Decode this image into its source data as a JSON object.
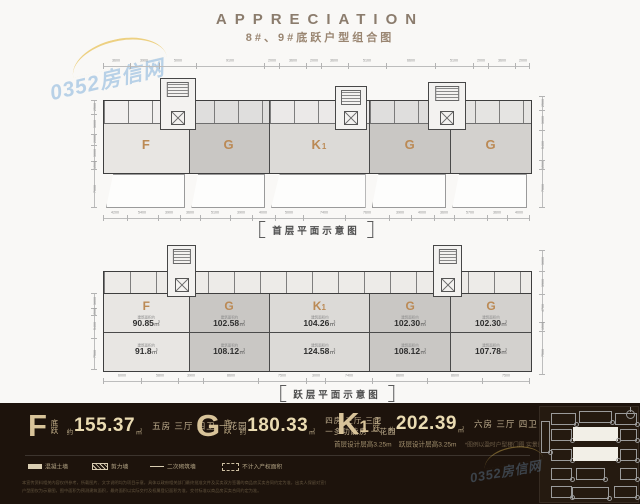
{
  "header": {
    "title": "APPRECIATION",
    "subtitle": "8#、9#底跃户型组合图"
  },
  "watermark": {
    "text": "0352房信网"
  },
  "plan1": {
    "caption": "首层平面示意图",
    "units": [
      {
        "label": "F",
        "sub": ""
      },
      {
        "label": "G",
        "sub": ""
      },
      {
        "label": "K",
        "sub": "1"
      },
      {
        "label": "G",
        "sub": ""
      },
      {
        "label": "G",
        "sub": ""
      }
    ],
    "dims_top": [
      "3600",
      "3900",
      "5000",
      "9100",
      "2000",
      "3600",
      "2000",
      "3600",
      "5100",
      "6600",
      "5100",
      "2000",
      "3600",
      "2000"
    ],
    "dims_bottom": [
      "4200",
      "5400",
      "3900",
      "3600",
      "5100",
      "3900",
      "4000",
      "5000",
      "7400",
      "7600",
      "3900",
      "4000",
      "3600",
      "5700",
      "3600",
      "4000"
    ],
    "dims_left": [
      "2500",
      "3600",
      "2000",
      "3000",
      "1500",
      "7000"
    ],
    "dims_right": [
      "2500",
      "3600",
      "5400",
      "1500",
      "7000"
    ]
  },
  "plan2": {
    "caption": "跃层平面示意图",
    "area_note": "建筑面积约",
    "units": [
      {
        "label": "F",
        "sub": "",
        "upper": "90.85",
        "lower": "91.8",
        "unit": "㎡"
      },
      {
        "label": "G",
        "sub": "",
        "upper": "102.58",
        "lower": "108.12",
        "unit": "㎡"
      },
      {
        "label": "K",
        "sub": "1",
        "upper": "104.26",
        "lower": "124.58",
        "unit": "㎡"
      },
      {
        "label": "G",
        "sub": "",
        "upper": "102.30",
        "lower": "108.12",
        "unit": "㎡"
      },
      {
        "label": "G",
        "sub": "",
        "upper": "102.30",
        "lower": "107.78",
        "unit": "㎡"
      }
    ],
    "dims_left": [
      "3600",
      "1500",
      "5400",
      "7500"
    ],
    "dims_right": [
      "3600",
      "3900",
      "4700",
      "1500",
      "7500"
    ],
    "dims_bottom": [
      "6000",
      "5800",
      "3900",
      "8600",
      "7500",
      "3000",
      "7400",
      "8600",
      "8600",
      "7500"
    ]
  },
  "footer": {
    "units": [
      {
        "letter": "F",
        "letter_sub": "",
        "tier": "底跃",
        "approx": "约",
        "area": "155.37",
        "unit": "㎡",
        "desc1": "五房 三厅 四卫 一花园",
        "desc2": ""
      },
      {
        "letter": "G",
        "letter_sub": "",
        "tier": "底跃",
        "approx": "约",
        "area": "180.33",
        "unit": "㎡",
        "desc1": "四房 三厅 三卫",
        "desc2": "一多功能房 一花园"
      },
      {
        "letter": "K",
        "letter_sub": "1",
        "tier": "底跃",
        "approx": "约",
        "area": "202.39",
        "unit": "㎡",
        "desc1": "六房 三厅 四卫 一花园",
        "desc2": ""
      }
    ],
    "heights_note1": "首层设计层高3.25m",
    "heights_note2": "跃层设计层高3.25m",
    "heights_small": "*图例以盈时户型楼门图 实景量为准",
    "legend": [
      {
        "type": "solid",
        "label": "混凝土墙"
      },
      {
        "type": "hatch",
        "label": "剪力墙"
      },
      {
        "type": "line",
        "label": "二次砌筑墙"
      },
      {
        "type": "dashed",
        "label": "不计入产权面积"
      }
    ],
    "disclaimer_line1": "本宣传资料相关内容仅供参考，所载图片、文字说明均为项目示意，具体以政府相关部门最终批准文件及买卖双方签署的商品房买卖合同约定为准，出卖人保留对宣传资料修改的权利，敬请留意。",
    "disclaimer_line2": "户型图仅为示意图，图中面积为预测建筑面积，最终面积以实际交付及权属登记面积为准，交付标准以商品房买卖合同约定为准。"
  },
  "keyplan": {
    "buildings": [
      {
        "x": 1,
        "y": 14,
        "w": 7,
        "h": 30,
        "f": 0
      },
      {
        "x": 11,
        "y": 6,
        "w": 23,
        "h": 10,
        "f": 0
      },
      {
        "x": 39,
        "y": 4,
        "w": 31,
        "h": 10,
        "f": 0
      },
      {
        "x": 75,
        "y": 6,
        "w": 20,
        "h": 10,
        "f": 0
      },
      {
        "x": 11,
        "y": 22,
        "w": 19,
        "h": 10,
        "f": 0
      },
      {
        "x": 33,
        "y": 20,
        "w": 43,
        "h": 12,
        "f": 1
      },
      {
        "x": 80,
        "y": 22,
        "w": 15,
        "h": 10,
        "f": 0
      },
      {
        "x": 11,
        "y": 42,
        "w": 19,
        "h": 10,
        "f": 0
      },
      {
        "x": 33,
        "y": 40,
        "w": 43,
        "h": 12,
        "f": 1
      },
      {
        "x": 80,
        "y": 42,
        "w": 15,
        "h": 10,
        "f": 0
      },
      {
        "x": 11,
        "y": 61,
        "w": 19,
        "h": 10,
        "f": 0
      },
      {
        "x": 36,
        "y": 61,
        "w": 27,
        "h": 10,
        "f": 0
      },
      {
        "x": 80,
        "y": 61,
        "w": 15,
        "h": 10,
        "f": 0
      },
      {
        "x": 11,
        "y": 79,
        "w": 19,
        "h": 10,
        "f": 0
      },
      {
        "x": 32,
        "y": 80,
        "w": 35,
        "h": 10,
        "f": 0
      },
      {
        "x": 74,
        "y": 79,
        "w": 21,
        "h": 10,
        "f": 0
      }
    ]
  }
}
